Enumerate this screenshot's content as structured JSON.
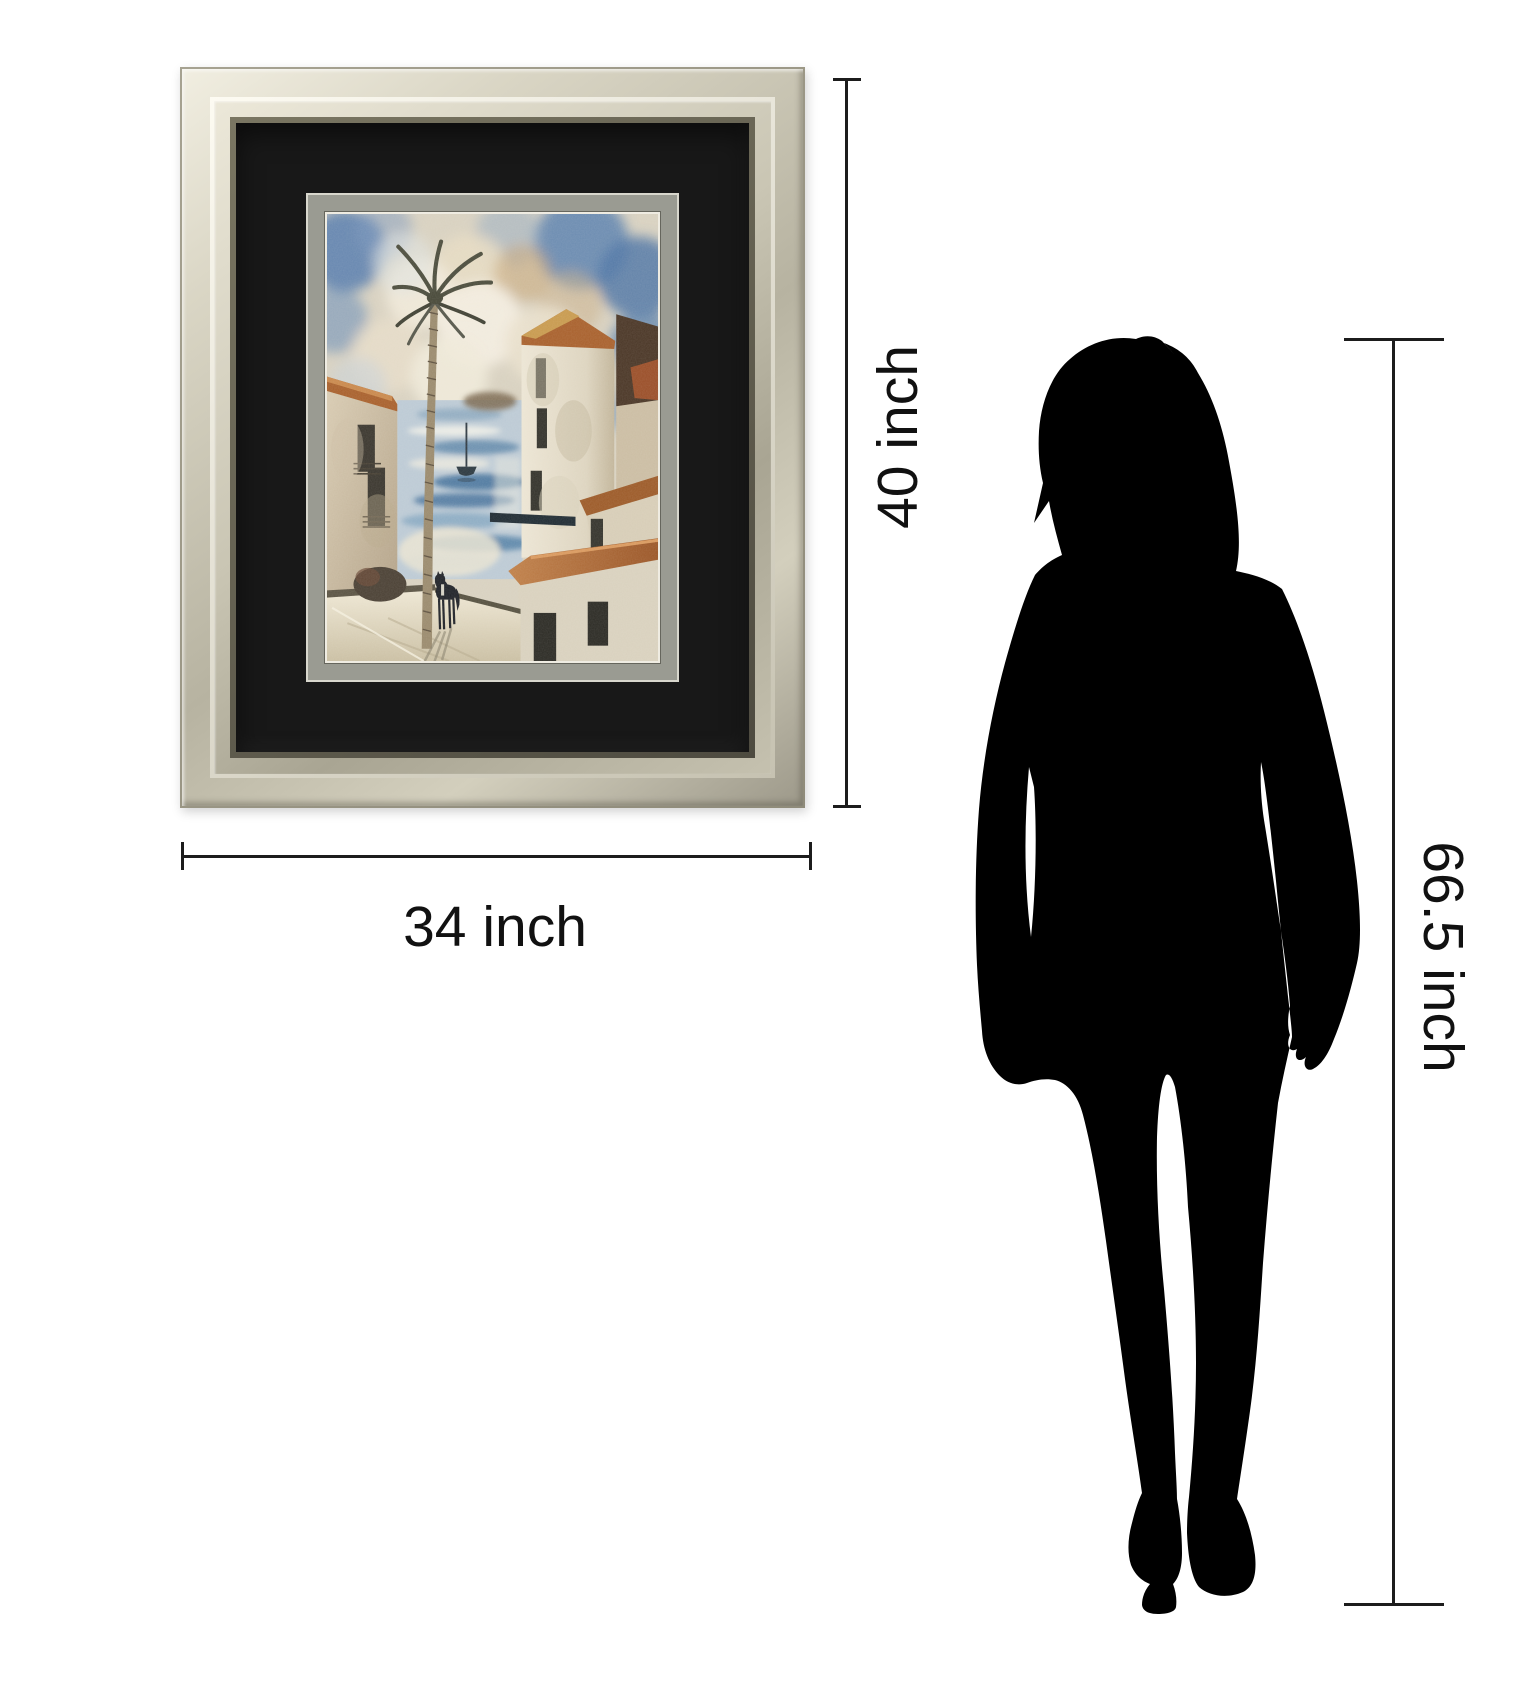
{
  "page": {
    "background_color": "#ffffff"
  },
  "artwork": {
    "frame_finish": "champagne-silver",
    "frame_highlight_color": "#f1eee1",
    "frame_midtone_color": "#b7b3a1",
    "outer_mat_color": "#181818",
    "inner_mat_color": "#9a9b92",
    "painting": {
      "scene": "Mediterranean harbor village with palm tree, white houses, terracotta roofs, sailboat, water and a horse",
      "sky_blue": "#5b80ae",
      "cloud_cream": "#efe8d8",
      "wall_white": "#e6dfcf",
      "roof_terracotta": "#a8602c",
      "water_blue": "#3f6f99",
      "dark_accent": "#23262b"
    }
  },
  "annotations": {
    "line_color": "#1c1c1c",
    "text_color": "#111111",
    "frame_height": {
      "label": "40 inch"
    },
    "frame_width": {
      "label": "34 inch"
    },
    "person_height": {
      "label": "66.5 inch"
    }
  },
  "person": {
    "kind": "woman silhouette",
    "color": "#000000"
  }
}
